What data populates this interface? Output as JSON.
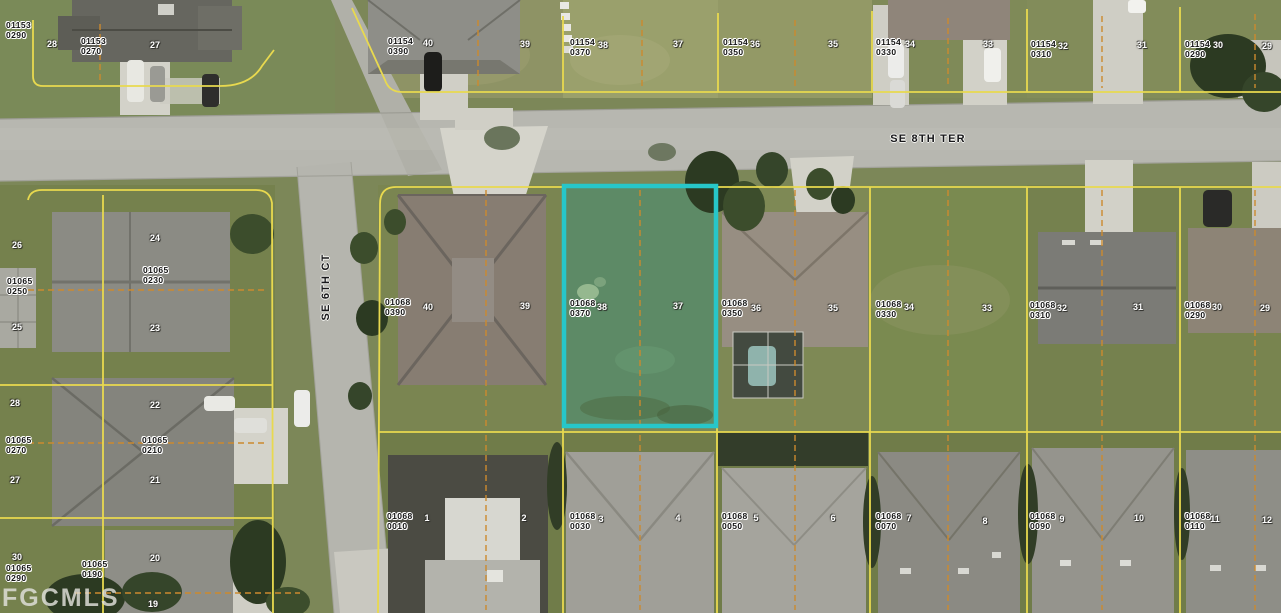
{
  "map": {
    "watermark": "FGCMLS",
    "streets": [
      {
        "name": "SE 8TH TER",
        "orientation": "horizontal",
        "x": 928,
        "y": 139
      },
      {
        "name": "SE 6TH CT",
        "orientation": "vertical",
        "x": 326,
        "y": 287
      }
    ],
    "highlight": {
      "parcel_id": "01068 0370",
      "color": "#27c6c9",
      "x": 564,
      "y": 186,
      "width": 152,
      "height": 240
    },
    "line_colors": {
      "parcel_boundary": "#e8d94f",
      "half_lot_dashed": "#cc8a2e"
    },
    "parcel_labels": [
      {
        "line1": "01153",
        "line2": "0290",
        "x": 6,
        "y": 20
      },
      {
        "line1": "01153",
        "line2": "0270",
        "x": 81,
        "y": 36
      },
      {
        "line1": "01154",
        "line2": "0390",
        "x": 388,
        "y": 36
      },
      {
        "line1": "01154",
        "line2": "0370",
        "x": 570,
        "y": 37
      },
      {
        "line1": "01154",
        "line2": "0350",
        "x": 723,
        "y": 37
      },
      {
        "line1": "01154",
        "line2": "0330",
        "x": 876,
        "y": 37
      },
      {
        "line1": "01154",
        "line2": "0310",
        "x": 1031,
        "y": 39
      },
      {
        "line1": "01154",
        "line2": "0290",
        "x": 1185,
        "y": 39
      },
      {
        "line1": "01065",
        "line2": "0250",
        "x": 7,
        "y": 276
      },
      {
        "line1": "01065",
        "line2": "0230",
        "x": 143,
        "y": 265
      },
      {
        "line1": "01065",
        "line2": "0270",
        "x": 6,
        "y": 435
      },
      {
        "line1": "01065",
        "line2": "0210",
        "x": 142,
        "y": 435
      },
      {
        "line1": "01065",
        "line2": "0290",
        "x": 6,
        "y": 563
      },
      {
        "line1": "01065",
        "line2": "0190",
        "x": 82,
        "y": 559
      },
      {
        "line1": "01068",
        "line2": "0390",
        "x": 385,
        "y": 297
      },
      {
        "line1": "01068",
        "line2": "0370",
        "x": 570,
        "y": 298
      },
      {
        "line1": "01068",
        "line2": "0350",
        "x": 722,
        "y": 298
      },
      {
        "line1": "01068",
        "line2": "0330",
        "x": 876,
        "y": 299
      },
      {
        "line1": "01068",
        "line2": "0310",
        "x": 1030,
        "y": 300
      },
      {
        "line1": "01068",
        "line2": "0290",
        "x": 1185,
        "y": 300
      },
      {
        "line1": "01068",
        "line2": "0010",
        "x": 387,
        "y": 511
      },
      {
        "line1": "01068",
        "line2": "0030",
        "x": 570,
        "y": 511
      },
      {
        "line1": "01068",
        "line2": "0050",
        "x": 722,
        "y": 511
      },
      {
        "line1": "01068",
        "line2": "0070",
        "x": 876,
        "y": 511
      },
      {
        "line1": "01068",
        "line2": "0090",
        "x": 1030,
        "y": 511
      },
      {
        "line1": "01068",
        "line2": "0110",
        "x": 1185,
        "y": 511
      }
    ],
    "lot_numbers": [
      {
        "n": "28",
        "x": 52,
        "y": 44
      },
      {
        "n": "27",
        "x": 155,
        "y": 45
      },
      {
        "n": "40",
        "x": 428,
        "y": 43
      },
      {
        "n": "39",
        "x": 525,
        "y": 44
      },
      {
        "n": "38",
        "x": 603,
        "y": 45
      },
      {
        "n": "37",
        "x": 678,
        "y": 44
      },
      {
        "n": "36",
        "x": 755,
        "y": 44
      },
      {
        "n": "35",
        "x": 833,
        "y": 44
      },
      {
        "n": "34",
        "x": 910,
        "y": 44
      },
      {
        "n": "33",
        "x": 988,
        "y": 44
      },
      {
        "n": "32",
        "x": 1063,
        "y": 46
      },
      {
        "n": "31",
        "x": 1142,
        "y": 45
      },
      {
        "n": "30",
        "x": 1218,
        "y": 45
      },
      {
        "n": "29",
        "x": 1267,
        "y": 46
      },
      {
        "n": "26",
        "x": 17,
        "y": 245
      },
      {
        "n": "25",
        "x": 17,
        "y": 327
      },
      {
        "n": "28",
        "x": 15,
        "y": 403
      },
      {
        "n": "27",
        "x": 15,
        "y": 480
      },
      {
        "n": "30",
        "x": 17,
        "y": 557
      },
      {
        "n": "24",
        "x": 155,
        "y": 238
      },
      {
        "n": "23",
        "x": 155,
        "y": 328
      },
      {
        "n": "22",
        "x": 155,
        "y": 405
      },
      {
        "n": "21",
        "x": 155,
        "y": 480
      },
      {
        "n": "20",
        "x": 155,
        "y": 558
      },
      {
        "n": "19",
        "x": 153,
        "y": 604
      },
      {
        "n": "40",
        "x": 428,
        "y": 307
      },
      {
        "n": "39",
        "x": 525,
        "y": 306
      },
      {
        "n": "38",
        "x": 602,
        "y": 307
      },
      {
        "n": "37",
        "x": 678,
        "y": 306
      },
      {
        "n": "36",
        "x": 756,
        "y": 308
      },
      {
        "n": "35",
        "x": 833,
        "y": 308
      },
      {
        "n": "34",
        "x": 909,
        "y": 307
      },
      {
        "n": "33",
        "x": 987,
        "y": 308
      },
      {
        "n": "32",
        "x": 1062,
        "y": 308
      },
      {
        "n": "31",
        "x": 1138,
        "y": 307
      },
      {
        "n": "30",
        "x": 1217,
        "y": 307
      },
      {
        "n": "29",
        "x": 1265,
        "y": 308
      },
      {
        "n": "1",
        "x": 427,
        "y": 518
      },
      {
        "n": "2",
        "x": 524,
        "y": 518
      },
      {
        "n": "3",
        "x": 601,
        "y": 519
      },
      {
        "n": "4",
        "x": 678,
        "y": 518
      },
      {
        "n": "5",
        "x": 756,
        "y": 518
      },
      {
        "n": "6",
        "x": 833,
        "y": 518
      },
      {
        "n": "7",
        "x": 909,
        "y": 518
      },
      {
        "n": "8",
        "x": 985,
        "y": 521
      },
      {
        "n": "9",
        "x": 1062,
        "y": 519
      },
      {
        "n": "10",
        "x": 1139,
        "y": 518
      },
      {
        "n": "11",
        "x": 1215,
        "y": 519
      },
      {
        "n": "12",
        "x": 1267,
        "y": 520
      }
    ]
  }
}
